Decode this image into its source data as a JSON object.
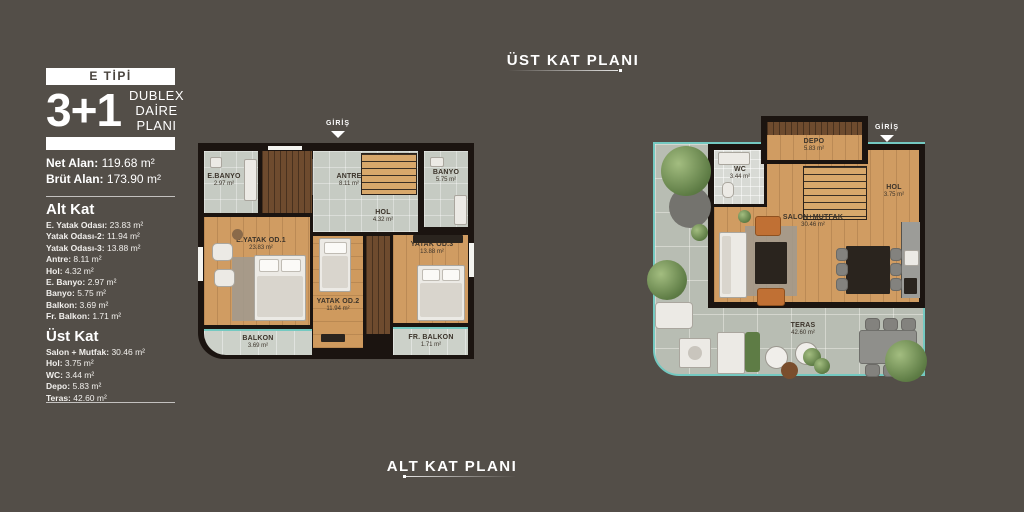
{
  "titles": {
    "top": "ÜST KAT PLANI",
    "bottom": "ALT KAT PLANI"
  },
  "sidebar": {
    "type_badge": "E TİPİ",
    "unit": "3+1",
    "unit_sub1": "DUBLEX",
    "unit_sub2": "DAİRE PLANI",
    "net_alan": {
      "label": "Net Alan:",
      "value": "119.68 m²"
    },
    "brut_alan": {
      "label": "Brüt Alan:",
      "value": "173.90 m²"
    },
    "alt_kat": {
      "heading": "Alt Kat",
      "items": [
        {
          "label": "E. Yatak Odası:",
          "value": "23.83 m²"
        },
        {
          "label": "Yatak Odası-2:",
          "value": "11.94 m²"
        },
        {
          "label": "Yatak Odası-3:",
          "value": "13.88 m²"
        },
        {
          "label": "Antre:",
          "value": "8.11 m²"
        },
        {
          "label": "Hol:",
          "value": "4.32 m²"
        },
        {
          "label": "E. Banyo:",
          "value": "2.97 m²"
        },
        {
          "label": "Banyo:",
          "value": "5.75 m²"
        },
        {
          "label": "Balkon:",
          "value": "3.69 m²"
        },
        {
          "label": "Fr. Balkon:",
          "value": "1.71 m²"
        }
      ]
    },
    "ust_kat": {
      "heading": "Üst Kat",
      "items": [
        {
          "label": "Salon + Mutfak:",
          "value": "30.46 m²"
        },
        {
          "label": "Hol:",
          "value": "3.75 m²"
        },
        {
          "label": "WC:",
          "value": "3.44 m²"
        },
        {
          "label": "Depo:",
          "value": "5.83 m²"
        },
        {
          "label": "Teras:",
          "value": "42.60 m²"
        }
      ]
    }
  },
  "plans": {
    "alt": {
      "giris": "GİRİŞ",
      "rooms": {
        "e_banyo": {
          "name": "E.BANYO",
          "area": "2.97 m²"
        },
        "antre": {
          "name": "ANTRE",
          "area": "8.11 m²"
        },
        "banyo": {
          "name": "BANYO",
          "area": "5.75 m²"
        },
        "hol": {
          "name": "HOL",
          "area": "4.32 m²"
        },
        "e_yatak": {
          "name": "E.YATAK OD.1",
          "area": "23.83 m²"
        },
        "yatak2": {
          "name": "YATAK OD.2",
          "area": "11.94 m²"
        },
        "yatak3": {
          "name": "YATAK OD.3",
          "area": "13.88 m²"
        },
        "balkon": {
          "name": "BALKON",
          "area": "3.69 m²"
        },
        "fr_balkon": {
          "name": "FR. BALKON",
          "area": "1.71 m²"
        }
      }
    },
    "ust": {
      "giris": "GİRİŞ",
      "rooms": {
        "wc": {
          "name": "WC",
          "area": "3.44 m²"
        },
        "depo": {
          "name": "DEPO",
          "area": "5.83 m²"
        },
        "hol": {
          "name": "HOL",
          "area": "3.75 m²"
        },
        "salon": {
          "name": "SALON+MUTFAK",
          "area": "30.46 m²"
        },
        "teras": {
          "name": "TERAS",
          "area": "42.60 m²"
        }
      }
    }
  },
  "colors": {
    "background": "#534e48",
    "wall": "#1b1410",
    "wood_floor": "#d09c62",
    "tile_floor": "#c6cbc3",
    "terrace_tile": "#b8bdb3",
    "glass_teal": "#74c9c1",
    "text_white": "#ffffff",
    "label_dark": "#3b332a"
  }
}
